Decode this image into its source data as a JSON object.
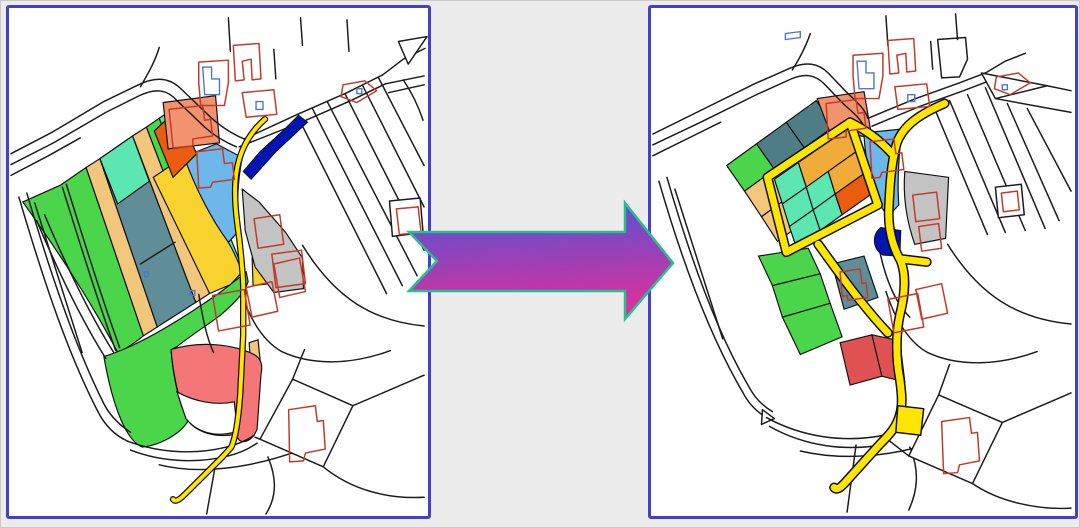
{
  "page": {
    "background": "#ececec",
    "frame_border": "#c9c9c9"
  },
  "panels": {
    "before": {
      "id": "land-parcels-before",
      "border_color": "#4341cc",
      "background": "#ffffff",
      "features": [
        "strip-parcels",
        "winding-yellow-road",
        "navy-pond",
        "gray-parcels",
        "red-building-outlines",
        "pink-parcel",
        "green-field"
      ]
    },
    "after": {
      "id": "land-parcels-after",
      "border_color": "#4341cc",
      "background": "#ffffff",
      "features": [
        "block-grid-parcels",
        "new-yellow-road-loop",
        "navy-pond",
        "gray-parcels",
        "red-building-outlines",
        "red-parcels",
        "green-crescent"
      ]
    }
  },
  "arrow": {
    "direction": "right",
    "gradient_top": "#4f55d4",
    "gradient_bottom": "#dd2f9c",
    "outline": "#2bbd92"
  },
  "palette": {
    "map_line": "#1c1c1c",
    "house_red": "#c23b2a",
    "house_blue": "#4b79c9",
    "road_yellow": "#ffe500",
    "road_casing": "#101010",
    "parcel_stroke": "#111111",
    "navy": "#0014b4",
    "skyblue": "#6db7ea",
    "salmon": "#f2926e",
    "orange_red": "#ea5c10",
    "amber": "#f0ab38",
    "sandy": "#f2c77c",
    "gold": "#f8d22e",
    "turquoise": "#5ce6b2",
    "teal_slate": "#4e7d85",
    "slate": "#5f8e98",
    "green": "#4bd54b",
    "gray_parcel": "#c3c3c3",
    "red_parcel": "#e05151",
    "pink_red": "#f57676",
    "white": "#ffffff"
  }
}
